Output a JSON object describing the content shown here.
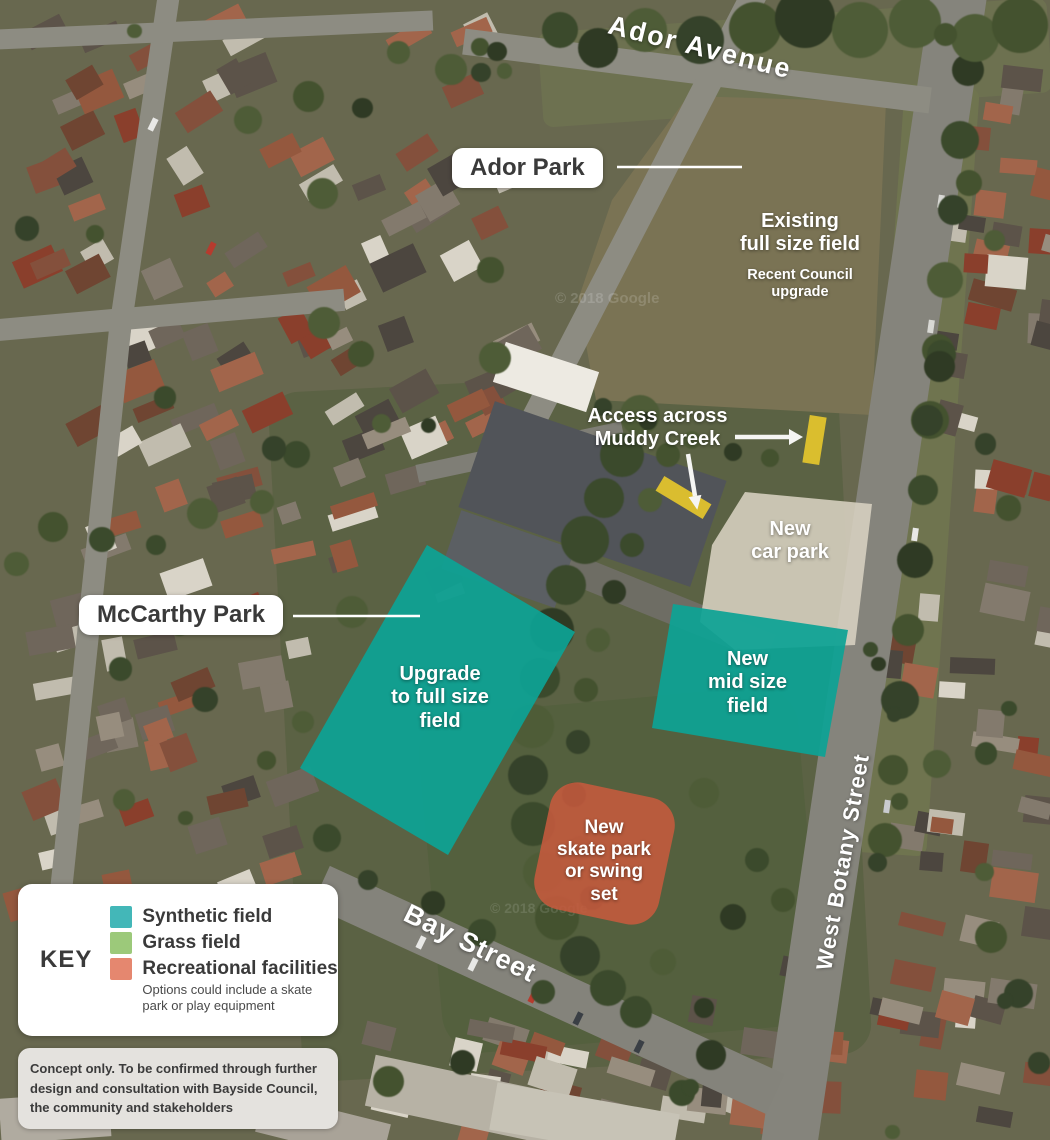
{
  "streets": {
    "ador_avenue": "Ador Avenue",
    "bay_street": "Bay Street",
    "west_botany_street": "West Botany Street"
  },
  "park_labels": {
    "ador_park": "Ador Park",
    "mccarthy_park": "McCarthy Park"
  },
  "annotations": {
    "existing_field": {
      "title": "Existing\nfull size field",
      "note": "Recent Council\nupgrade"
    },
    "access": {
      "label": "Access across\nMuddy Creek"
    },
    "car_park": {
      "label": "New\ncar park"
    },
    "upgrade_field": {
      "label": "Upgrade\nto full size\nfield"
    },
    "mid_field": {
      "label": "New\nmid size\nfield"
    },
    "recreation": {
      "label": "New\nskate park\nor swing\nset"
    }
  },
  "key": {
    "title": "KEY",
    "items": [
      {
        "label": "Synthetic field",
        "color": "#43b7b8"
      },
      {
        "label": "Grass field",
        "color": "#9cc97a"
      },
      {
        "label": "Recreational facilities",
        "color": "#e5876f",
        "note": "Options could include a skate\npark or play equipment"
      }
    ]
  },
  "disclaimer": "Concept only. To be confirmed through further\ndesign and consultation with Bayside Council,\nthe community and stakeholders",
  "watermark": "© 2018 Google",
  "overlay_colors": {
    "synthetic_field": "#0da295",
    "car_park": "#d9d2c2",
    "recreation": "#c65a3e",
    "creek_access": "#e2c32d"
  }
}
